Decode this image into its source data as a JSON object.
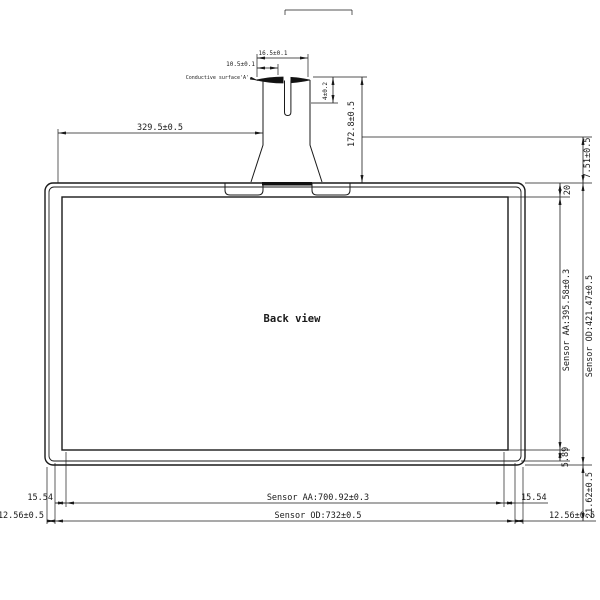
{
  "drawing": {
    "view_title": "Back view",
    "line_color": "#1a1a1a",
    "background_color": "#ffffff",
    "labels": {
      "conductive_surface": "Conductive surface'A'",
      "tail_pad_width_outer": "16.5±0.1",
      "tail_pad_width_inner": "10.5±0.1",
      "pad_height": "4±0.2",
      "tail_length": "172.8±0.5",
      "tail_offset": "329.5±0.5",
      "top_margin": "7.51±0.5",
      "top_border": "20",
      "sensor_aa_vertical": "Sensor AA:395.58±0.3",
      "sensor_od_vertical": "Sensor OD:421.47±0.5",
      "bottom_inner": "5.89",
      "bottom_margin": "21.62±0.5",
      "left_border": "15.54",
      "right_border": "15.54",
      "left_edge": "12.56±0.5",
      "right_edge": "12.56±0.5",
      "sensor_aa_horizontal": "Sensor AA:700.92±0.3",
      "sensor_od_horizontal": "Sensor OD:732±0.5"
    }
  }
}
